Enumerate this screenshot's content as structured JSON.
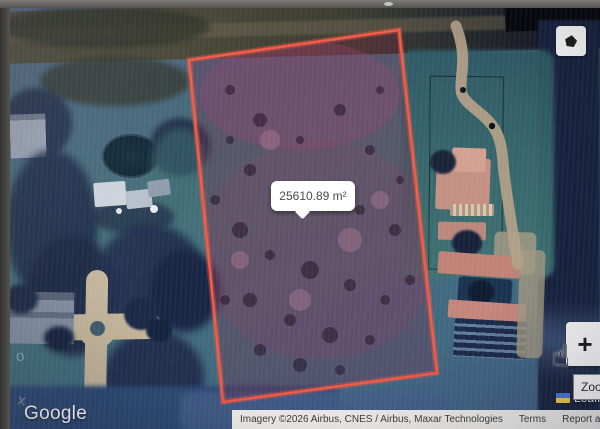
{
  "measurement": {
    "area_label": "25610.89 m²"
  },
  "controls": {
    "zoom_in_label": "+",
    "zoom_tooltip": "Zoom in",
    "polygon_tool_icon": "pentagon-icon",
    "cursor_icon": "hand-cursor"
  },
  "map": {
    "google_logo": "Google",
    "attribution": {
      "imagery": "Imagery ©2026 Airbus, CNES / Airbus, Maxar Technologies",
      "terms": "Terms",
      "report_error": "Report a map error"
    },
    "leaflet": {
      "label": "Leaflet",
      "flag_icon": "ukraine-flag"
    }
  },
  "colors": {
    "polygon_stroke": "#f15b45",
    "polygon_fill": "rgba(126,36,66,0.30)",
    "tooltip_background": "#ffffff",
    "attribution_background": "#f3f2ef"
  }
}
